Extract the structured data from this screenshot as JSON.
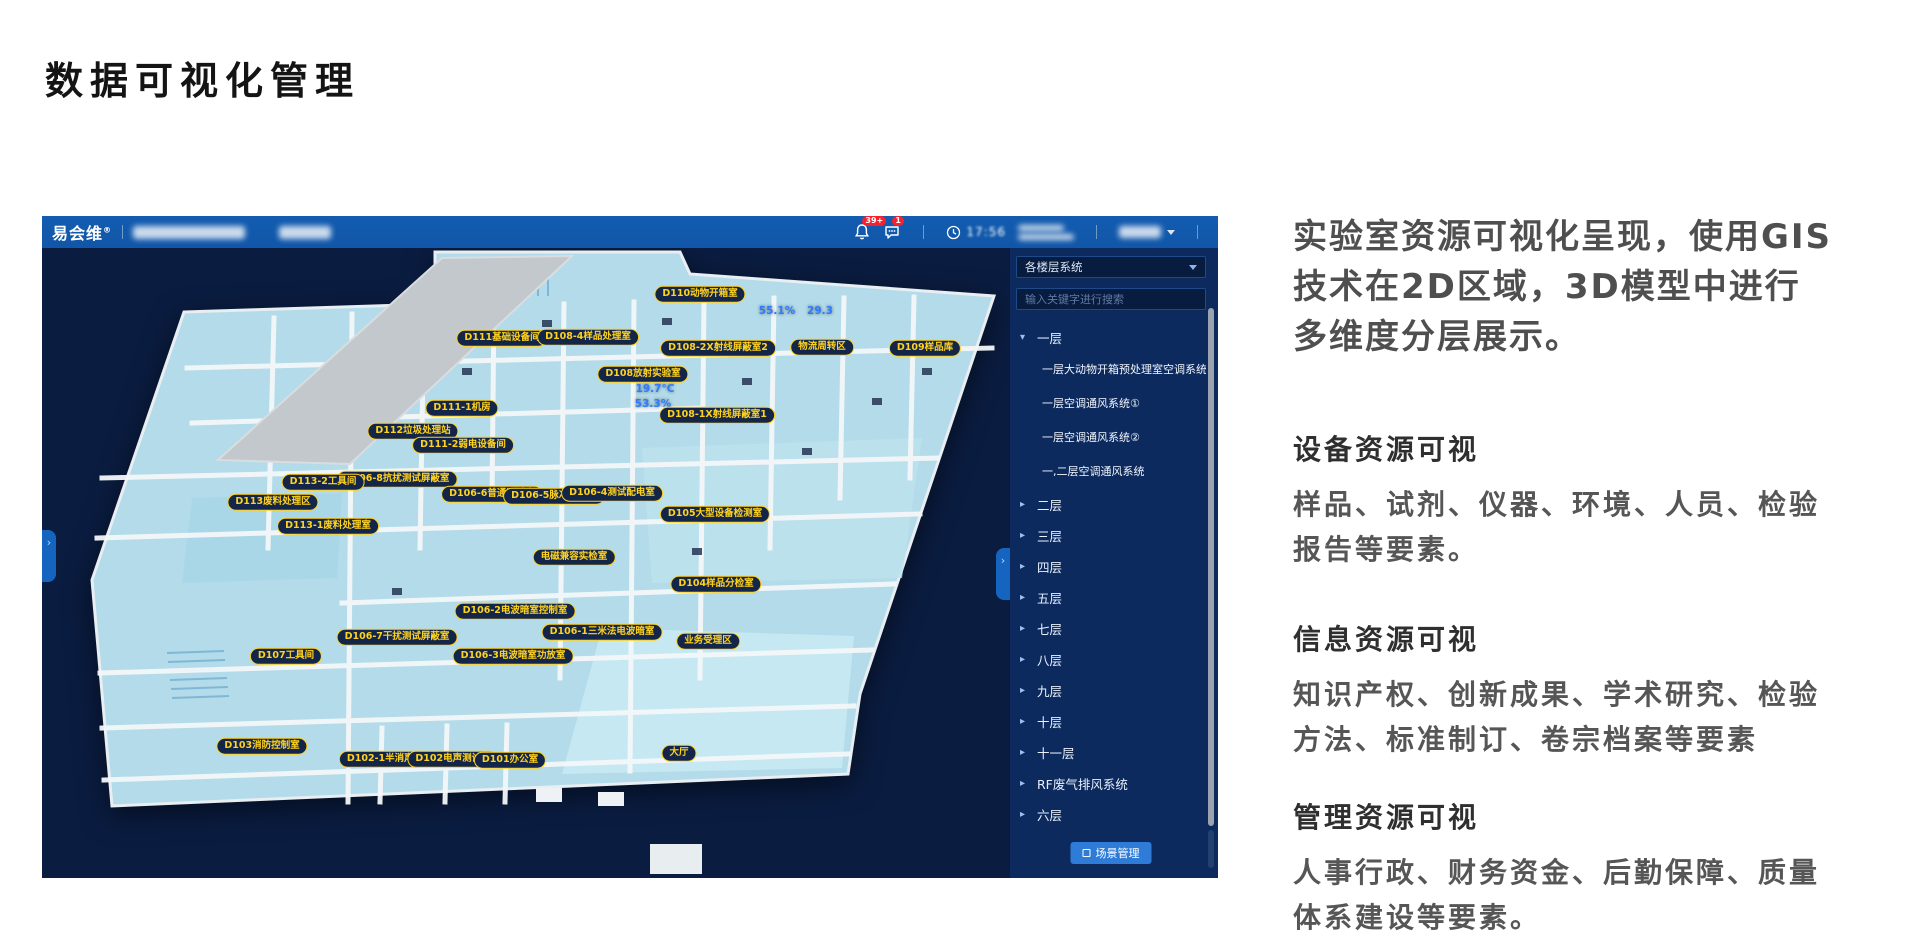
{
  "page": {
    "title": "数据可视化管理"
  },
  "colors": {
    "topbar-blue": "#1156a8",
    "panel-navy": "#0d2a5f",
    "content-navy": "#0a1c40",
    "label-yellow": "#ffd21e",
    "accent-blue": "#2e7cd8",
    "badge-red": "#f5222d",
    "sensor-blue": "#2f7bff",
    "floor-fill": "#b3dbe9"
  },
  "app": {
    "topbar": {
      "logo": "易会维",
      "logo_reg": "®",
      "bell_badge": "39+",
      "chat_badge": "1",
      "time": "17:56"
    },
    "sidebar": {
      "dropdown_value": "各楼层系统",
      "search_placeholder": "输入关键字进行搜索",
      "tree": [
        {
          "label": "一层",
          "expanded": true,
          "children": [
            "一层大动物开箱预处理室空调系统",
            "一层空调通风系统①",
            "一层空调通风系统②",
            "一,二层空调通风系统"
          ]
        },
        {
          "label": "二层"
        },
        {
          "label": "三层"
        },
        {
          "label": "四层"
        },
        {
          "label": "五层"
        },
        {
          "label": "七层"
        },
        {
          "label": "八层"
        },
        {
          "label": "九层"
        },
        {
          "label": "十层"
        },
        {
          "label": "十一层"
        },
        {
          "label": "RF废气排风系统"
        },
        {
          "label": "六层"
        }
      ],
      "scene_button": "场景管理"
    },
    "floorplan": {
      "labels": [
        {
          "text": "D110动物开箱室",
          "x": 658,
          "y": 46
        },
        {
          "text": "D111基础设备间",
          "x": 460,
          "y": 90
        },
        {
          "text": "D108-4样品处理室",
          "x": 546,
          "y": 89
        },
        {
          "text": "D108-2X射线屏蔽室2",
          "x": 676,
          "y": 100
        },
        {
          "text": "物流周转区",
          "x": 780,
          "y": 99
        },
        {
          "text": "D109样品库",
          "x": 883,
          "y": 100
        },
        {
          "text": "D108放射实验室",
          "x": 601,
          "y": 126
        },
        {
          "text": "D108-1X射线屏蔽室1",
          "x": 675,
          "y": 167
        },
        {
          "text": "D111-1机房",
          "x": 420,
          "y": 160
        },
        {
          "text": "D112垃圾处理站",
          "x": 371,
          "y": 183
        },
        {
          "text": "D111-2弱电设备间",
          "x": 421,
          "y": 197
        },
        {
          "text": "D106-8抗扰测试屏蔽室",
          "x": 355,
          "y": 231
        },
        {
          "text": "D113-2工具间",
          "x": 281,
          "y": 234
        },
        {
          "text": "D113废料处理区",
          "x": 231,
          "y": 254
        },
        {
          "text": "D106-6普通测试室",
          "x": 450,
          "y": 246
        },
        {
          "text": "D106-5脉冲测试室",
          "x": 512,
          "y": 248
        },
        {
          "text": "D106-4测试配电室",
          "x": 570,
          "y": 245
        },
        {
          "text": "D113-1废料处理室",
          "x": 286,
          "y": 278
        },
        {
          "text": "D105大型设备检测室",
          "x": 673,
          "y": 266
        },
        {
          "text": "电磁兼容实检室",
          "x": 532,
          "y": 309
        },
        {
          "text": "D104样品分检室",
          "x": 674,
          "y": 336
        },
        {
          "text": "D106-2电波暗室控制室",
          "x": 473,
          "y": 363
        },
        {
          "text": "D106-1三米法电波暗室",
          "x": 560,
          "y": 384
        },
        {
          "text": "D106-7干扰测试屏蔽室",
          "x": 355,
          "y": 389
        },
        {
          "text": "D106-3电波暗室功放室",
          "x": 471,
          "y": 408
        },
        {
          "text": "业务受理区",
          "x": 666,
          "y": 393
        },
        {
          "text": "D107工具间",
          "x": 244,
          "y": 408
        },
        {
          "text": "D103消防控制室",
          "x": 220,
          "y": 498
        },
        {
          "text": "D102-1半消声室",
          "x": 343,
          "y": 511
        },
        {
          "text": "D102电声测试室",
          "x": 411,
          "y": 511
        },
        {
          "text": "D101办公室",
          "x": 468,
          "y": 512
        },
        {
          "text": "大厅",
          "x": 637,
          "y": 505
        }
      ],
      "sensors": [
        {
          "text": "55.1%",
          "x": 735,
          "y": 63
        },
        {
          "text": "29.3",
          "x": 778,
          "y": 63
        },
        {
          "text": "19.7°C",
          "x": 613,
          "y": 141
        },
        {
          "text": "53.3%",
          "x": 611,
          "y": 156
        }
      ]
    }
  },
  "right_panel": {
    "intro": "实验室资源可视化呈现，使用GIS技术在2D区域，3D模型中进行多维度分层展示。",
    "sections": [
      {
        "title": "设备资源可视",
        "body": "样品、试剂、仪器、环境、人员、检验报告等要素。",
        "top": 428
      },
      {
        "title": "信息资源可视",
        "body": "知识产权、创新成果、学术研究、检验方法、标准制订、卷宗档案等要素",
        "top": 618
      },
      {
        "title": "管理资源可视",
        "body": "人事行政、财务资金、后勤保障、质量体系建设等要素。",
        "top": 796
      }
    ]
  }
}
